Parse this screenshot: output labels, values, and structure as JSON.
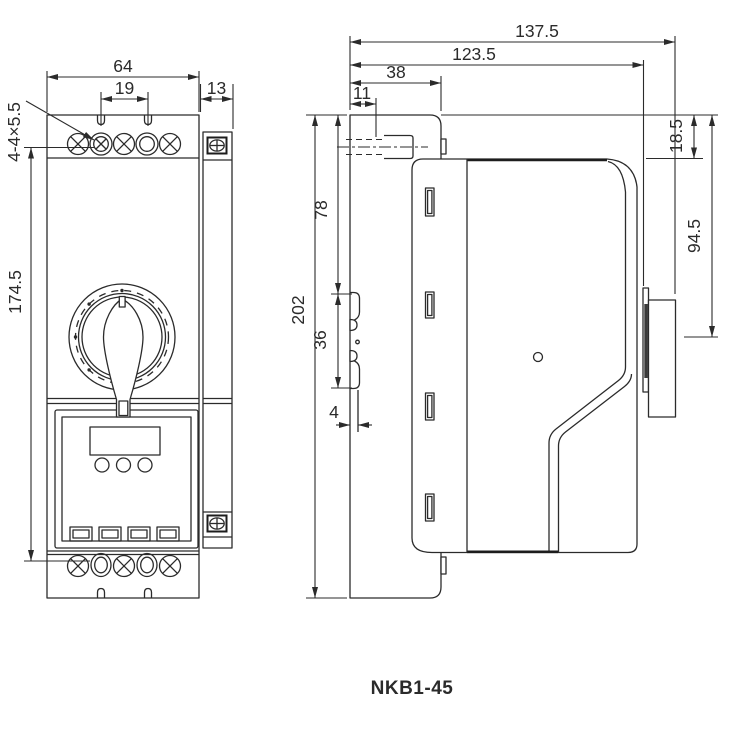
{
  "meta": {
    "model": "NKB1-45",
    "line_color": "#2b2b2b",
    "background": "#ffffff"
  },
  "front_view": {
    "name": "front view",
    "dims": {
      "width_total": "64",
      "terminal_pitch": "19",
      "bracket_width": "13",
      "mounting_holes": "4-4×5.5",
      "mounting_height": "174.5"
    }
  },
  "side_view": {
    "name": "side view",
    "dims": {
      "depth_total": "137.5",
      "depth_to_face": "123.5",
      "base_top_width": "38",
      "terminal_inset": "11",
      "height_total": "202",
      "rail_offset_top": "78",
      "rail_slot_height": "36",
      "rail_hook_depth": "4",
      "body_top_inset": "18.5",
      "handle_center_offset": "94.5"
    }
  }
}
